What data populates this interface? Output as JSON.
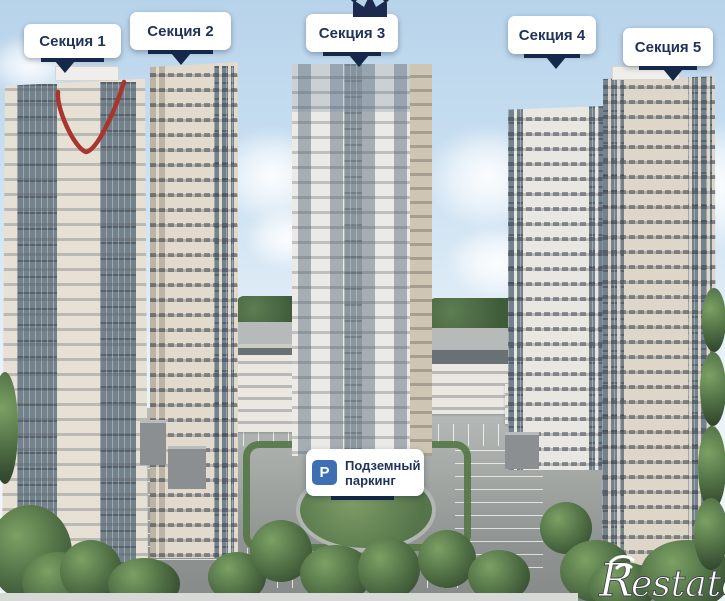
{
  "header": {
    "section_labels": [
      {
        "label": "Секция 1"
      },
      {
        "label": "Секция 2"
      },
      {
        "label": "Секция 3"
      },
      {
        "label": "Секция 4"
      },
      {
        "label": "Секция 5"
      }
    ]
  },
  "icons": {
    "crown": "crown-icon",
    "parking_letter": "P"
  },
  "parking_tooltip": {
    "line1": "Подземный",
    "line2": "паркинг"
  },
  "annotation": {
    "shape": "hand-drawn red check mark on section 1 roof"
  },
  "watermark": {
    "brand_r": "R",
    "brand_rest": "estate"
  },
  "colors": {
    "label_text": "#1e3357",
    "pointer_navy": "#16284a",
    "parking_blue": "#3d6fb2",
    "annotation_red": "#a8362e",
    "sky_top": "#b7d3ea",
    "facade_cream": "#e6e0d5",
    "glass_gray": "#74828c"
  }
}
